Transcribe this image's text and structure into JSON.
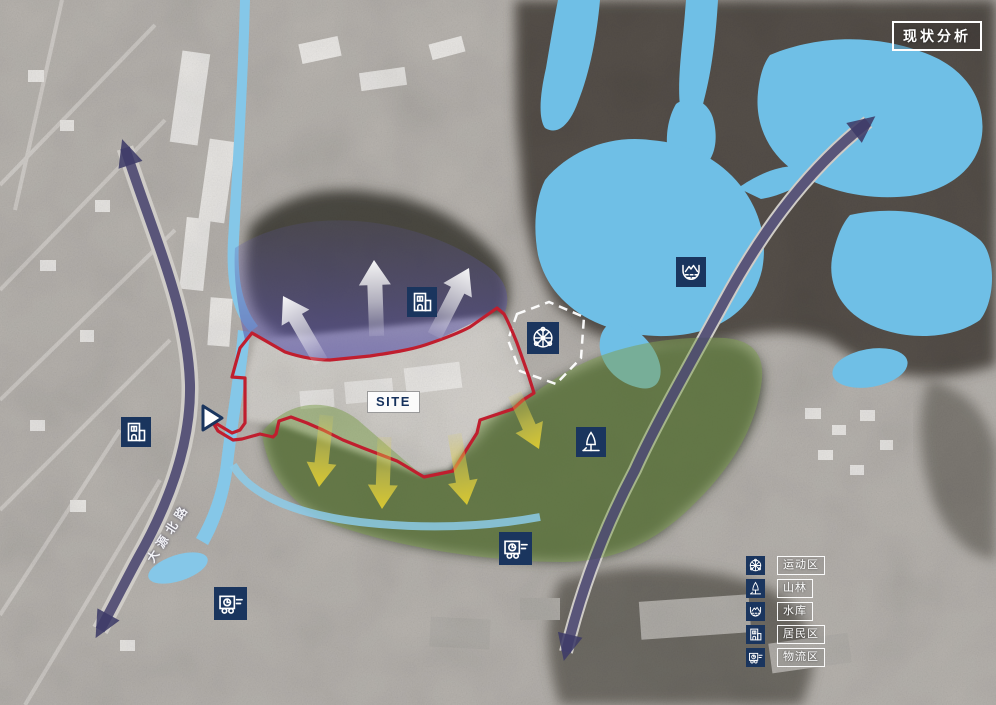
{
  "title_badge": "现状分析",
  "site_label": "SITE",
  "road_label": "大源北路",
  "legend": {
    "items": [
      {
        "icon": "ferris-wheel-icon",
        "label": "运动区"
      },
      {
        "icon": "tree-icon",
        "label": "山林"
      },
      {
        "icon": "reservoir-icon",
        "label": "水库"
      },
      {
        "icon": "building-icon",
        "label": "居民区"
      },
      {
        "icon": "truck-icon",
        "label": "物流区"
      }
    ]
  },
  "map_icons": [
    {
      "icon": "building-icon",
      "zone": "居民区"
    },
    {
      "icon": "building-icon",
      "zone": "居民区"
    },
    {
      "icon": "ferris-wheel-icon",
      "zone": "运动区"
    },
    {
      "icon": "reservoir-icon",
      "zone": "水库"
    },
    {
      "icon": "tree-icon",
      "zone": "山林"
    },
    {
      "icon": "truck-icon",
      "zone": "物流区"
    },
    {
      "icon": "truck-icon",
      "zone": "物流区"
    }
  ],
  "colors": {
    "water": "#6fbfe6",
    "purple_zone": "#5b54a8",
    "green_zone": "#7ea050",
    "site_boundary": "#c01e2e",
    "road_arrow": "#3e3b68",
    "flow_arrow_yellow": "#ddcb2f",
    "flow_arrow_white": "#ffffff",
    "icon_navy": "#1a355e"
  }
}
